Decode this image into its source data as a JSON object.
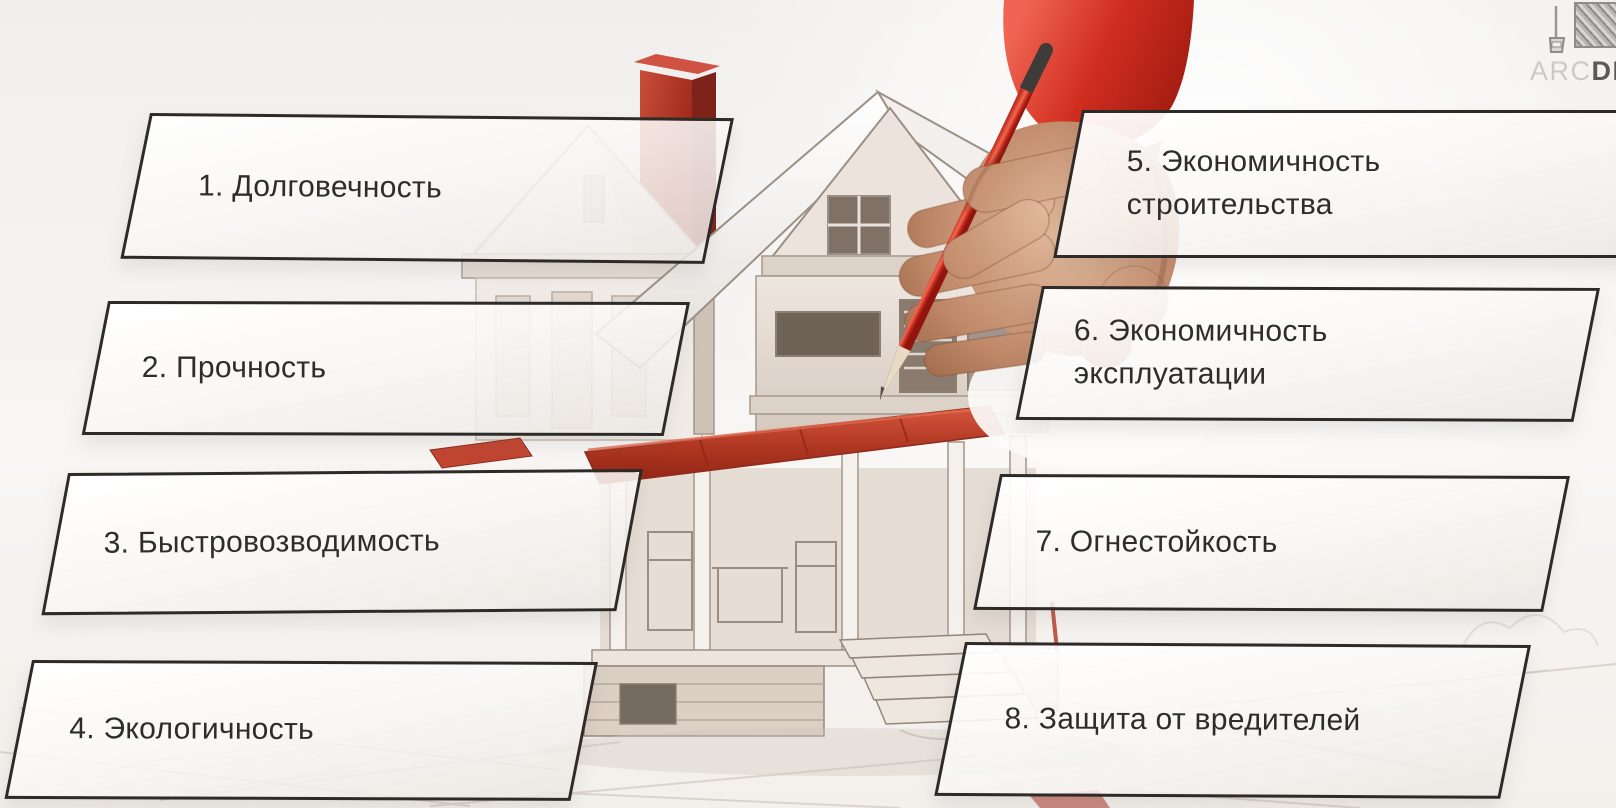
{
  "canvas": {
    "width": 1616,
    "height": 808
  },
  "watermark": {
    "brand_light": "ARC",
    "brand_dark": "DE",
    "logo_icon": "framed-sketch-and-drafting-lamp-icon"
  },
  "boxes": [
    {
      "number": 1,
      "line1": "1. Долговечность",
      "line2": ""
    },
    {
      "number": 2,
      "line1": "2. Прочность",
      "line2": ""
    },
    {
      "number": 3,
      "line1": "3. Быстровозводимость",
      "line2": ""
    },
    {
      "number": 4,
      "line1": "4. Экологичность",
      "line2": ""
    },
    {
      "number": 5,
      "line1": "5. Экономичность",
      "line2": "строительства"
    },
    {
      "number": 6,
      "line1": "6. Экономичность",
      "line2": "эксплуатации"
    },
    {
      "number": 7,
      "line1": "7. Огнестойкость",
      "line2": ""
    },
    {
      "number": 8,
      "line1": "8. Защита от вредителей",
      "line2": ""
    }
  ],
  "illustration": {
    "subject": "hand-drawing-house-sketch-with-red-pencil",
    "elements": [
      "house-pencil-sketch",
      "red-chimney",
      "red-porch-awning",
      "hand-holding-red-pencil",
      "red-sleeve",
      "ground-sketch-lines"
    ]
  },
  "colors": {
    "background": "#f2f0ee",
    "box_border": "#2d2a28",
    "box_fill": "#fbf9f7",
    "text": "#2f2d2b",
    "accent_red": "#bf3d2c",
    "pencil_red": "#d8402f",
    "sleeve_red": "#d02d1f",
    "skin": "#c08a6b",
    "sketch_line": "#9b9086",
    "watermark_light": "#ccc9c7",
    "watermark_dark": "#5c5a58"
  }
}
